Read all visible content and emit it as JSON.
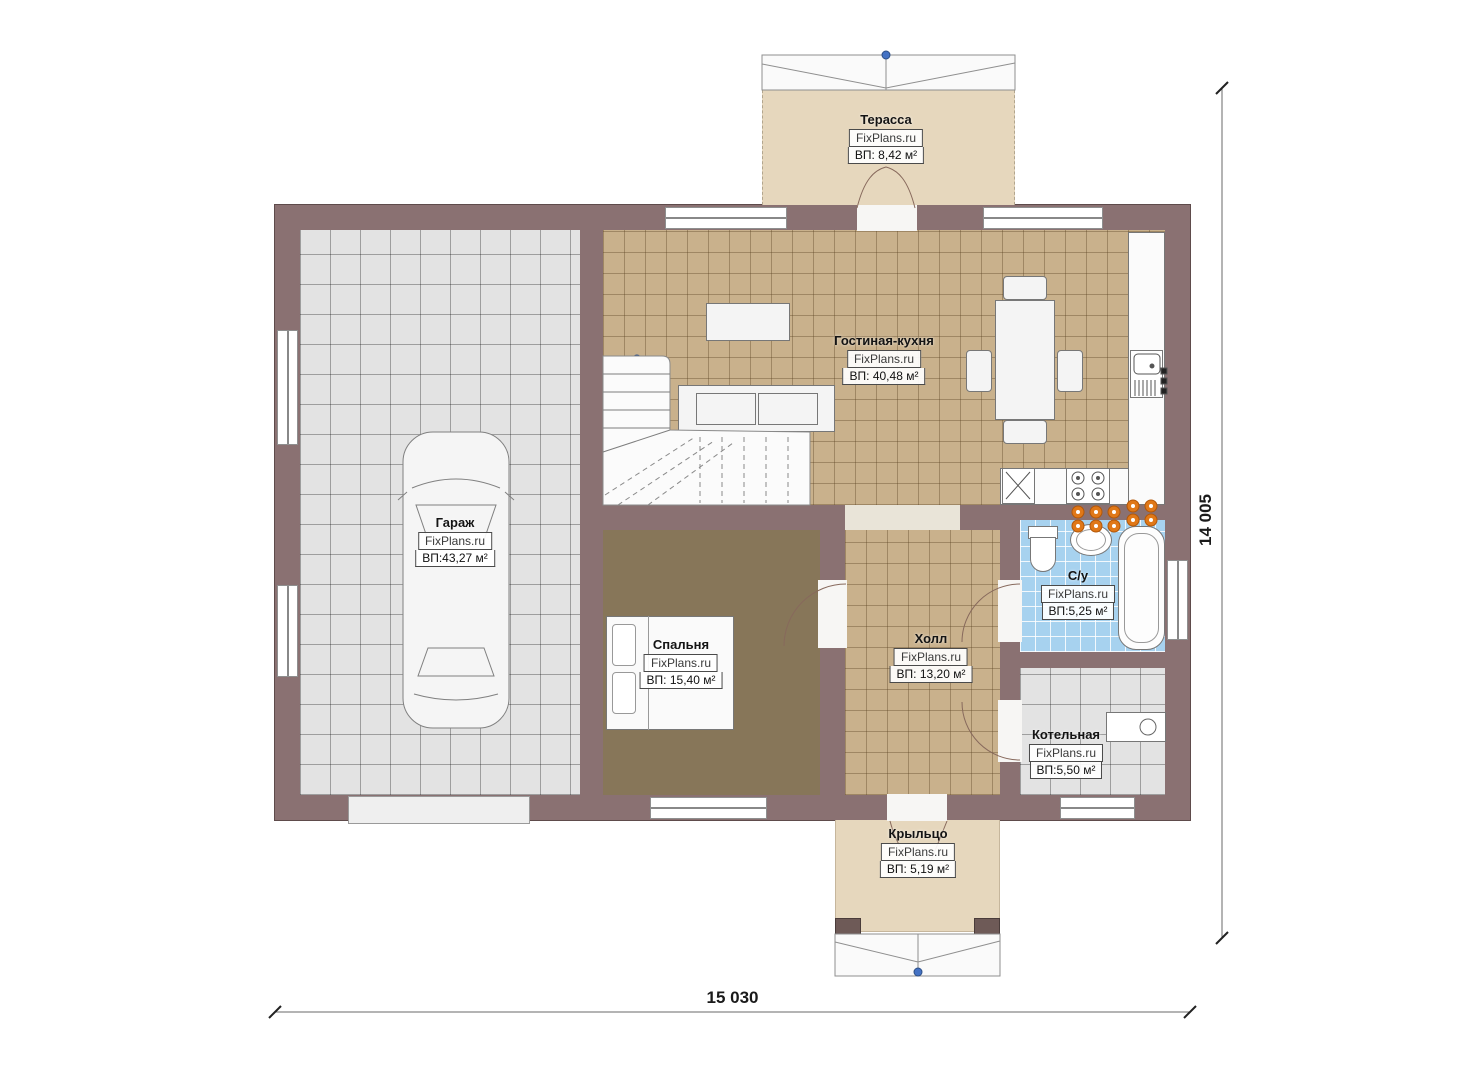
{
  "plan": {
    "watermark": "FixPlans.ru",
    "rooms": [
      {
        "name": "Терасса",
        "area": "ВП: 8,42 м²"
      },
      {
        "name": "Гостиная-кухня",
        "area": "ВП: 40,48 м²"
      },
      {
        "name": "Гараж",
        "area": "ВП:43,27 м²"
      },
      {
        "name": "Спальня",
        "area": "ВП: 15,40 м²"
      },
      {
        "name": "Холл",
        "area": "ВП: 13,20 м²"
      },
      {
        "name": "С/у",
        "area": "ВП:5,25 м²"
      },
      {
        "name": "Котельная",
        "area": "ВП:5,50 м²"
      },
      {
        "name": "Крыльцо",
        "area": "ВП: 5,19 м²"
      }
    ],
    "dimensions": {
      "width": "15 030",
      "height": "14 005"
    },
    "colors": {
      "wall": "#8a7172",
      "floor_tan": "#c9b18c",
      "floor_gray": "#e3e3e3",
      "floor_blue": "#a7d2ef",
      "floor_carpet": "#877659",
      "floor_beige": "#e6d7bd",
      "radiator_orange": "#e07818",
      "marker_blue": "#4472c4"
    }
  }
}
